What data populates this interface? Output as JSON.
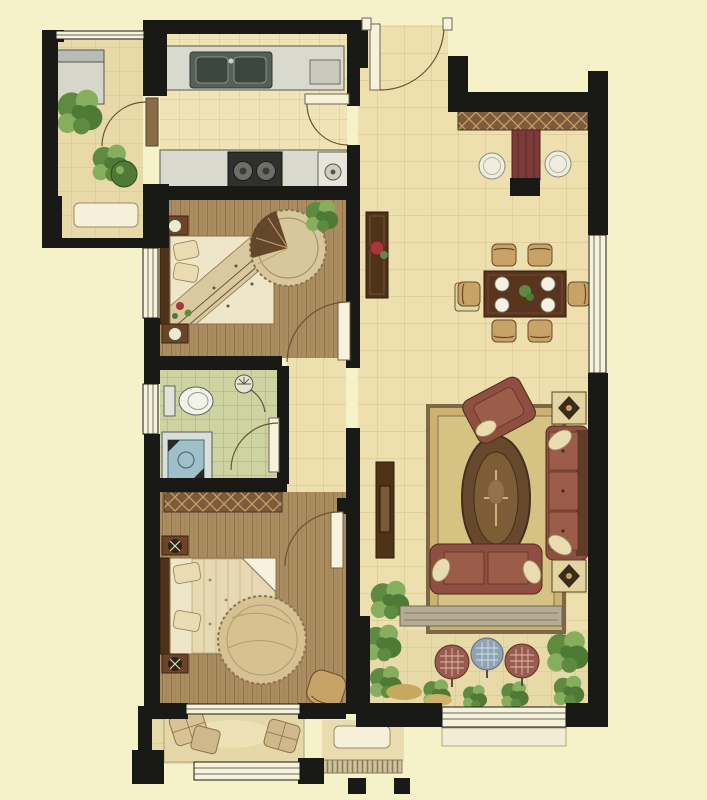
{
  "title": "two-bedroom-apartment-floor-plan",
  "palette": {
    "bg": "#f5f1c9",
    "wall": "#191915",
    "tile": "#eedfae",
    "grout": "#c8a86b",
    "kitchenTile": "#f0e3b6",
    "bathTile": "#cdd4a2",
    "bathGrout": "#9aa577",
    "balconyTile": "#e8daa8",
    "wood": "#a98c60",
    "woodLine": "#7e6038",
    "counter": "#d9d9cd",
    "windowFill": "#f7f2dc",
    "doorArc": "#6b5436",
    "furnDark": "#4f3319",
    "furnMid": "#6b4526",
    "chairTan": "#c8a368",
    "maroon": "#8e4f41",
    "maroonDeep": "#5f3c2e",
    "cream": "#efe5c8",
    "rug": "#cbb271",
    "rugBorder": "#7a6847",
    "rugOval": "#66492c",
    "hatchBase": "#7b5b3b",
    "hatchLine": "#caa06a",
    "accentRed": "#a83636",
    "plantDark": "#4e7a36",
    "plantMid": "#5e8a42",
    "plantLight": "#86ae5e",
    "ballRed": "#9a5a50",
    "ballBlue": "#8fa3b3",
    "stepGray": "#b5ad93",
    "mat": "#e4d7a8"
  },
  "rooms": [
    {
      "name": "service-balcony",
      "floor": "tile",
      "furniture": [
        "washing-machine",
        "potted-plants",
        "planter-sill",
        "balcony-door"
      ]
    },
    {
      "name": "kitchen",
      "floor": "tile",
      "furniture": [
        "sink-counter",
        "double-sink",
        "stove-counter",
        "two-burner-stove",
        "appliance",
        "kitchen-door"
      ]
    },
    {
      "name": "entry-foyer",
      "floor": "tile",
      "furniture": [
        "entrance-door",
        "shoe-cabinet",
        "hall-cabinet",
        "round-stool",
        "round-stool"
      ]
    },
    {
      "name": "dining-area",
      "floor": "tile",
      "furniture": [
        "dining-table",
        "six-chairs",
        "plates",
        "centerpiece",
        "console-with-flowers"
      ]
    },
    {
      "name": "living-room",
      "floor": "tile",
      "furniture": [
        "tv-cabinet",
        "area-rug",
        "three-seat-sofa",
        "loveseat",
        "armchair",
        "side-table-lamp",
        "side-table-lamp",
        "floor-plant",
        "step-to-balcony"
      ]
    },
    {
      "name": "master-bedroom",
      "floor": "wood",
      "furniture": [
        "double-bed",
        "nightstand-lamp",
        "nightstand-lamp",
        "round-rug",
        "plant",
        "door"
      ]
    },
    {
      "name": "bathroom",
      "floor": "bath-tile",
      "furniture": [
        "toilet",
        "vanity-basin",
        "shower",
        "door",
        "window"
      ]
    },
    {
      "name": "second-bedroom",
      "floor": "wood",
      "furniture": [
        "wardrobe",
        "double-bed",
        "nightstand-lamp",
        "nightstand-lamp",
        "round-rug",
        "armchair",
        "door"
      ]
    },
    {
      "name": "garden-balcony",
      "floor": "tile",
      "furniture": [
        "shrubs",
        "decor-ball-red",
        "decor-ball-blue",
        "decor-ball-red",
        "window"
      ]
    },
    {
      "name": "bedroom-balcony",
      "floor": "tile",
      "furniture": [
        "floor-mat",
        "cushion",
        "cushion",
        "window",
        "outdoor-planter"
      ]
    }
  ]
}
